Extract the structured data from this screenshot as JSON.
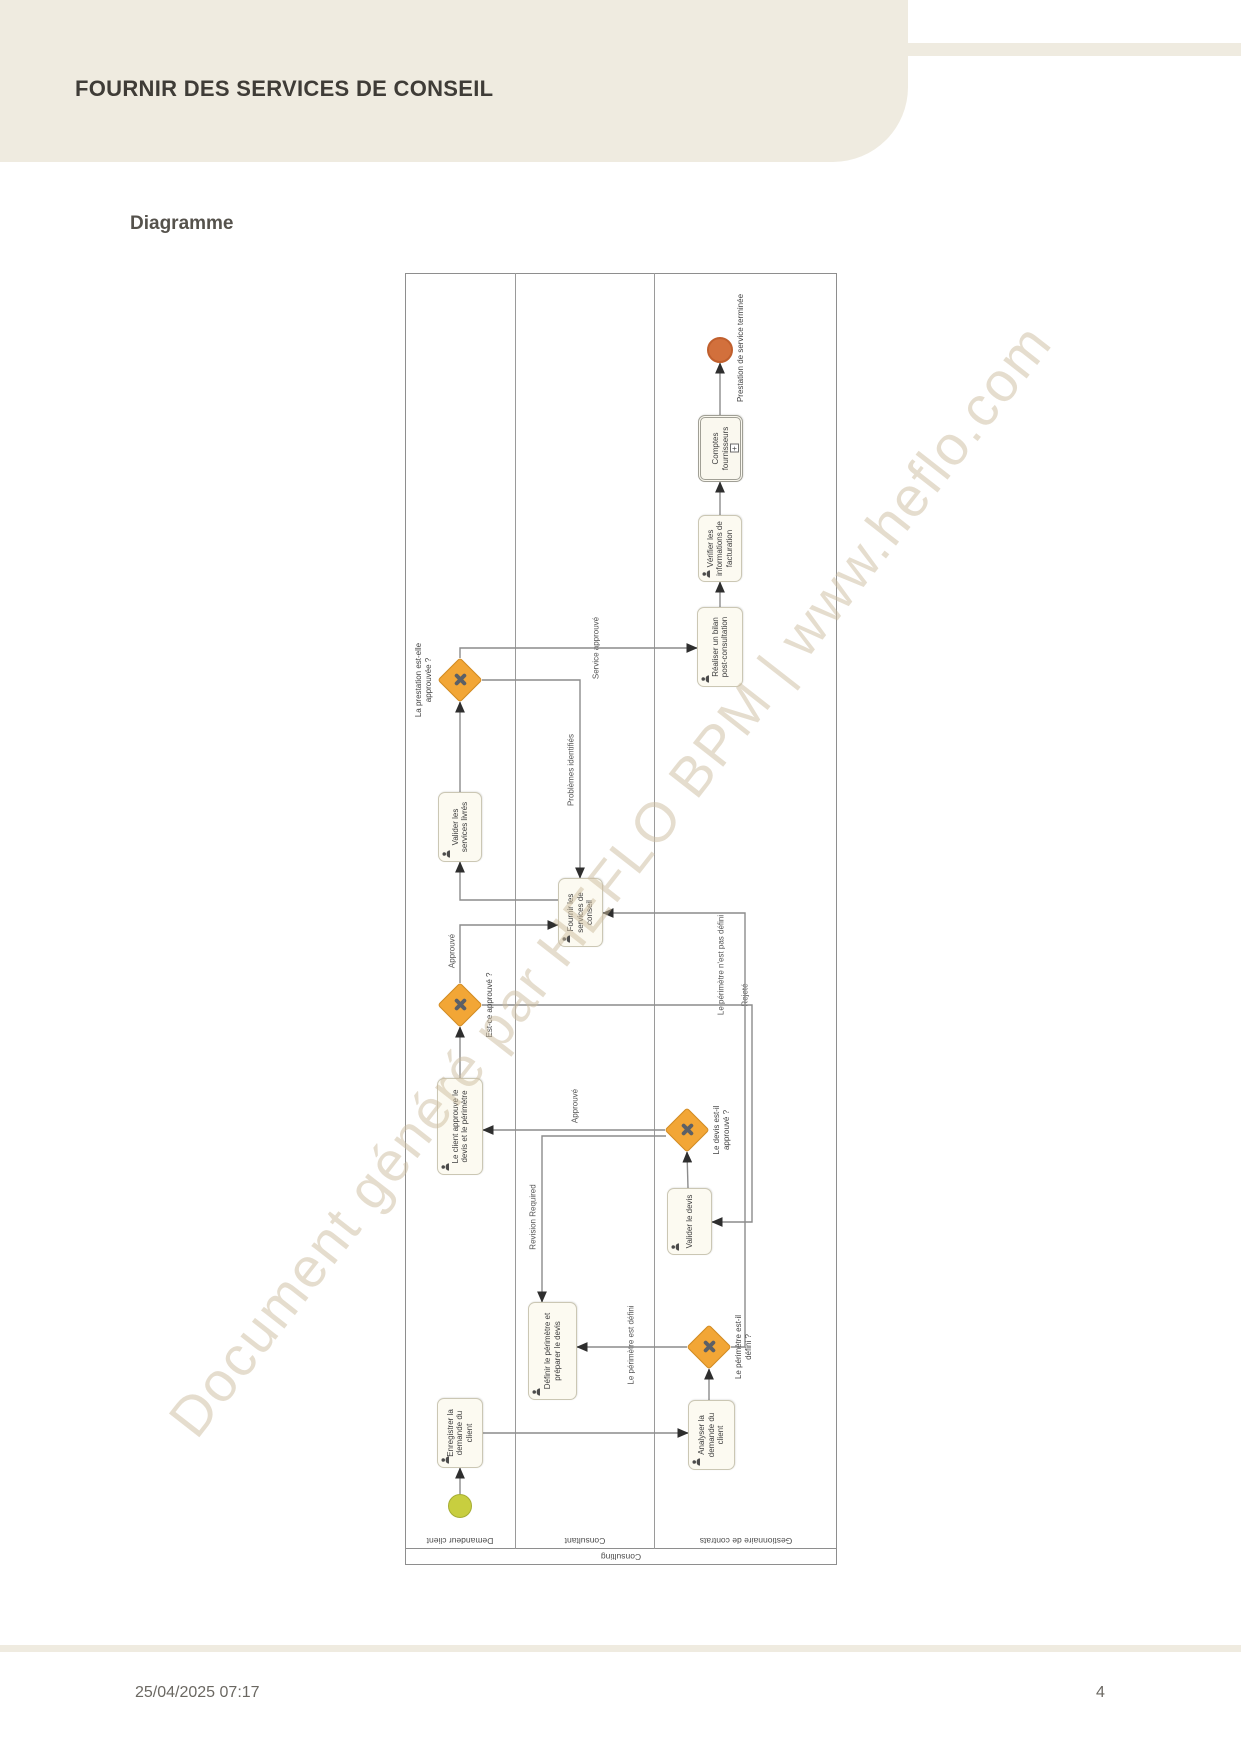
{
  "header": {
    "title": "FOURNIR DES SERVICES DE CONSEIL"
  },
  "section": {
    "heading": "Diagramme"
  },
  "watermark": {
    "text": "Document généré par HEFLO BPM | www.heflo.com"
  },
  "footer": {
    "datetime": "25/04/2025 07:17",
    "page": "4"
  },
  "colors": {
    "accent_cream": "#efebe0",
    "gateway_fill": "#f2a636",
    "gateway_border": "#d18a21",
    "gateway_x": "#5c6066",
    "task_fill": "#fcfaf1",
    "task_border": "#cbc7b4",
    "start_fill": "#c8ce3f",
    "start_border": "#a6ad33",
    "end_fill": "#d2703c",
    "end_border": "#c05f2d",
    "line": "#8c8c8c",
    "arrow": "#2e2e2e"
  },
  "diagram": {
    "pool_label": "Consulting",
    "lanes": [
      {
        "label": "Demandeur client",
        "height": 110
      },
      {
        "label": "Consultant",
        "height": 139
      },
      {
        "label": "Gestionnaire de contrats",
        "height": 183
      }
    ],
    "nodes": [
      {
        "id": "start",
        "type": "start",
        "x": 47,
        "y": 43,
        "w": 24,
        "h": 24,
        "label": ""
      },
      {
        "id": "t1",
        "type": "task",
        "x": 97,
        "y": 32,
        "w": 70,
        "h": 46,
        "label": "Enregistrer la demande du client"
      },
      {
        "id": "t2",
        "type": "task",
        "x": 95,
        "y": 283,
        "w": 70,
        "h": 47,
        "label": "Analyser la demande du client"
      },
      {
        "id": "g1",
        "type": "gateway",
        "x": 196,
        "y": 282,
        "w": 44,
        "h": 44,
        "label": "Le périmètre est-il défini ?",
        "label_pos": "below",
        "label_w": 72
      },
      {
        "id": "t3",
        "type": "task",
        "x": 165,
        "y": 123,
        "w": 98,
        "h": 49,
        "label": "Définir le périmètre et préparer le devis"
      },
      {
        "id": "t4",
        "type": "task",
        "x": 310,
        "y": 262,
        "w": 67,
        "h": 45,
        "label": "Valider le devis"
      },
      {
        "id": "g2",
        "type": "gateway",
        "x": 413,
        "y": 260,
        "w": 44,
        "h": 44,
        "label": "Le devis est-il approuvé ?",
        "label_pos": "below",
        "label_w": 62
      },
      {
        "id": "t5",
        "type": "task",
        "x": 390,
        "y": 32,
        "w": 97,
        "h": 46,
        "label": "Le client approuve le devis et le périmètre"
      },
      {
        "id": "g3",
        "type": "gateway",
        "x": 538,
        "y": 33,
        "w": 44,
        "h": 44,
        "label": "Est-ce approuvé ?",
        "label_pos": "below",
        "label_w": 84
      },
      {
        "id": "t6",
        "type": "task",
        "x": 618,
        "y": 153,
        "w": 69,
        "h": 45,
        "label": "Fournir les services de conseil"
      },
      {
        "id": "t7",
        "type": "task",
        "x": 703,
        "y": 33,
        "w": 70,
        "h": 44,
        "label": "Valider les services livrés"
      },
      {
        "id": "g4",
        "type": "gateway",
        "x": 863,
        "y": 33,
        "w": 44,
        "h": 44,
        "label": "La prestation est-elle approuvée ?",
        "label_pos": "above",
        "label_w": 92
      },
      {
        "id": "t8",
        "type": "task",
        "x": 878,
        "y": 292,
        "w": 80,
        "h": 46,
        "label": "Réaliser un bilan post-consultation"
      },
      {
        "id": "t9",
        "type": "task",
        "x": 983,
        "y": 293,
        "w": 67,
        "h": 44,
        "label": "Vérifier les informations de facturation"
      },
      {
        "id": "t10",
        "type": "subprocess",
        "x": 1083,
        "y": 293,
        "w": 67,
        "h": 45,
        "label": "Comptes fournisseurs"
      },
      {
        "id": "end",
        "type": "end",
        "x": 1202,
        "y": 302,
        "w": 26,
        "h": 26,
        "label": "Prestation de service terminée",
        "label_pos": "below"
      }
    ],
    "flows": [
      {
        "name": "start-to-enregistrer",
        "points": [
          [
            71,
            55
          ],
          [
            97,
            55
          ]
        ]
      },
      {
        "name": "enregistrer-to-analyser",
        "points": [
          [
            132,
            78
          ],
          [
            132,
            283
          ]
        ]
      },
      {
        "name": "analyser-to-gw-perimetre",
        "points": [
          [
            165,
            304
          ],
          [
            196,
            304
          ]
        ]
      },
      {
        "name": "perimetre-defini",
        "points": [
          [
            218,
            282
          ],
          [
            218,
            172
          ]
        ],
        "label": "Le périmètre est défini",
        "lx": 220,
        "ly": 226
      },
      {
        "name": "perimetre-pas-defini",
        "points": [
          [
            218,
            326
          ],
          [
            218,
            340
          ],
          [
            652,
            340
          ],
          [
            652,
            198
          ]
        ],
        "label": "Le périmètre n'est pas défini",
        "lx": 600,
        "ly": 316
      },
      {
        "name": "valider-devis-to-gw",
        "points": [
          [
            377,
            283
          ],
          [
            413,
            282
          ]
        ]
      },
      {
        "name": "devis-approuve",
        "points": [
          [
            435,
            260
          ],
          [
            435,
            78
          ]
        ],
        "label": "Approuvé",
        "lx": 459,
        "ly": 170
      },
      {
        "name": "revision-required",
        "points": [
          [
            429,
            261
          ],
          [
            429,
            137
          ],
          [
            263,
            137
          ]
        ],
        "label": "Revision Required",
        "lx": 348,
        "ly": 128
      },
      {
        "name": "client-to-gw-estce",
        "points": [
          [
            487,
            55
          ],
          [
            538,
            55
          ]
        ]
      },
      {
        "name": "estce-approuve",
        "points": [
          [
            582,
            55
          ],
          [
            640,
            55
          ],
          [
            640,
            153
          ]
        ],
        "label": "Approuvé",
        "lx": 614,
        "ly": 47
      },
      {
        "name": "rejete",
        "points": [
          [
            560,
            77
          ],
          [
            560,
            347
          ],
          [
            343,
            347
          ],
          [
            343,
            307
          ]
        ],
        "label": "Rejeté",
        "lx": 570,
        "ly": 340
      },
      {
        "name": "problemes-identifies",
        "points": [
          [
            885,
            77
          ],
          [
            885,
            175
          ],
          [
            687,
            175
          ]
        ],
        "label": "Problèmes identifiés",
        "lx": 795,
        "ly": 166
      },
      {
        "name": "service-approuve",
        "points": [
          [
            907,
            55
          ],
          [
            917,
            55
          ],
          [
            917,
            292
          ]
        ],
        "label": "Service approuvé",
        "lx": 917,
        "ly": 191
      },
      {
        "name": "fournir-to-valider-livres",
        "points": [
          [
            665,
            153
          ],
          [
            665,
            55
          ],
          [
            703,
            55
          ]
        ]
      },
      {
        "name": "valider-livres-to-gw-prestation",
        "points": [
          [
            773,
            55
          ],
          [
            863,
            55
          ]
        ]
      },
      {
        "name": "bilan-to-verifier",
        "points": [
          [
            958,
            315
          ],
          [
            983,
            315
          ]
        ]
      },
      {
        "name": "verifier-to-comptes",
        "points": [
          [
            1050,
            315
          ],
          [
            1083,
            315
          ]
        ]
      },
      {
        "name": "comptes-to-end",
        "points": [
          [
            1150,
            315
          ],
          [
            1202,
            315
          ]
        ]
      }
    ]
  }
}
